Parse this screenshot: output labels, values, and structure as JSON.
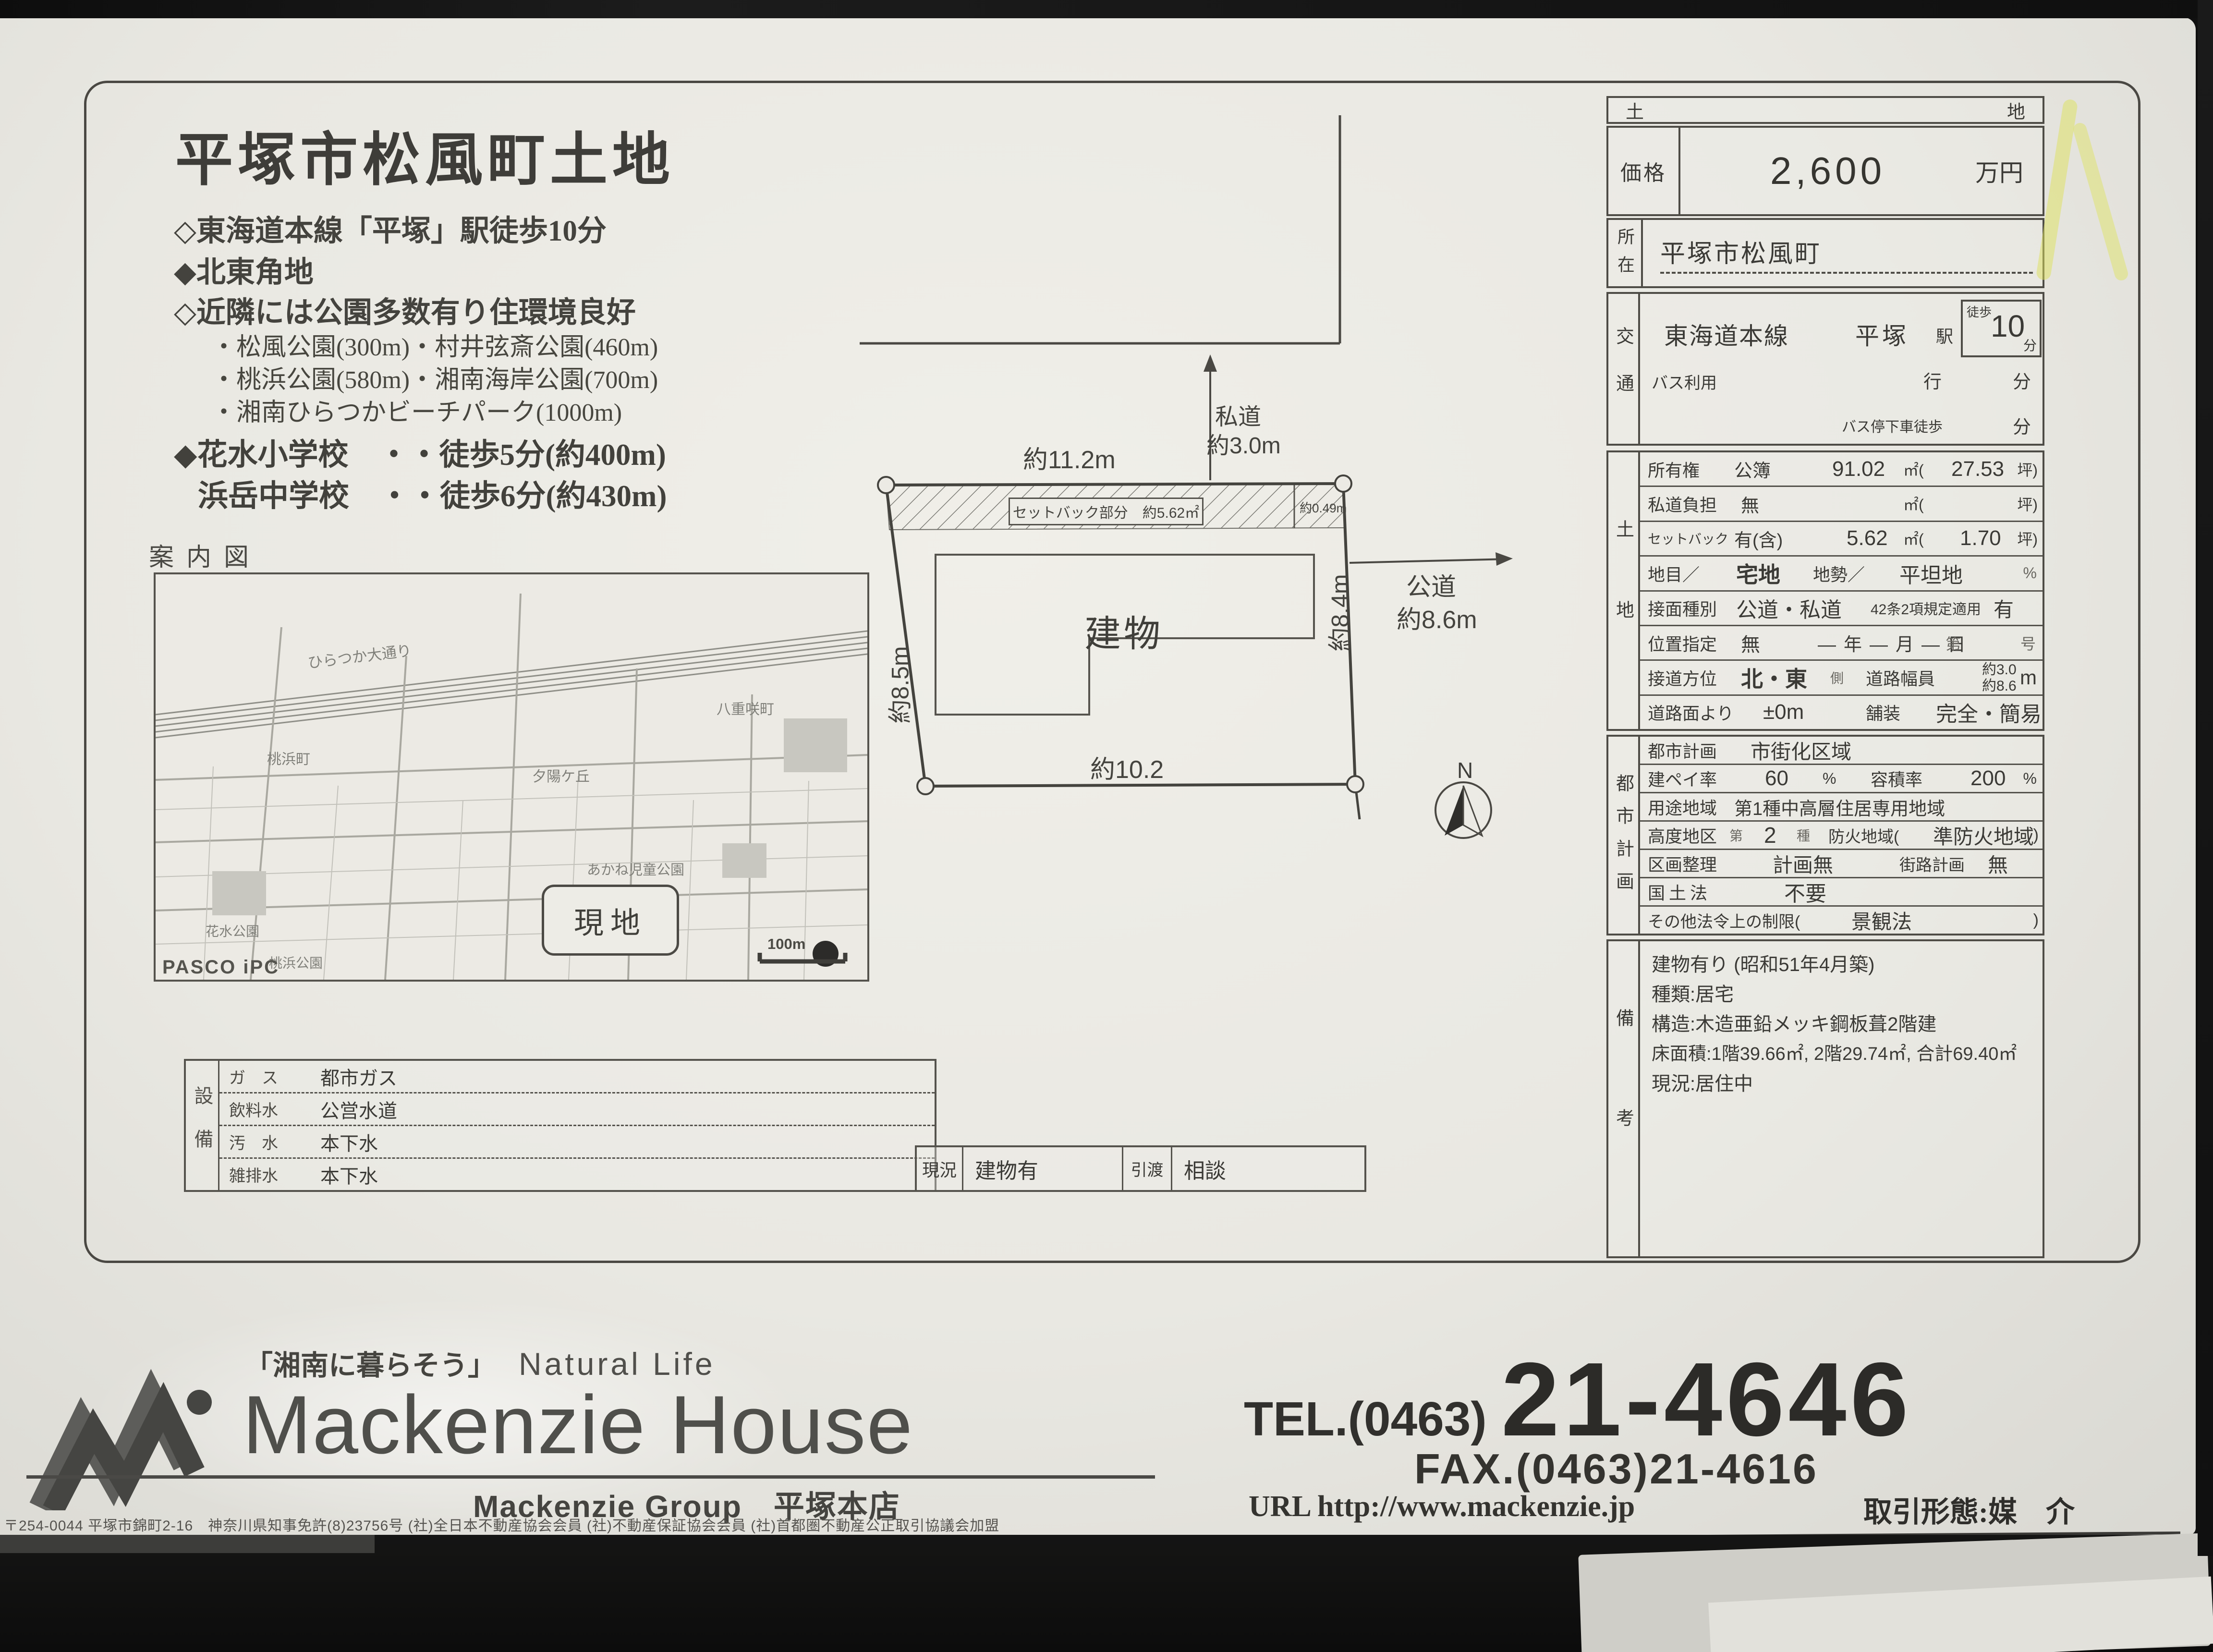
{
  "palette": {
    "background": "#141414",
    "paper": "#e9e8e2",
    "ink": "#3b3a36",
    "table_line": "#4e4c46",
    "map_ink": "#80807a",
    "highlighter": "#e0e45a"
  },
  "title_block": {
    "title": "平塚市松風町土地",
    "bullets": [
      "◇東海道本線「平塚」駅徒歩10分",
      "◆北東角地",
      "◇近隣には公園多数有り住環境良好"
    ],
    "parks": [
      "・松風公園(300m)・村井弦斎公園(460m)",
      "・桃浜公園(580m)・湘南海岸公園(700m)",
      "・湘南ひらつかビーチパーク(1000m)"
    ],
    "school_1": "◆花水小学校　・・徒歩5分(約400m)",
    "school_2": "浜岳中学校　・・徒歩6分(約430m)"
  },
  "guide_map": {
    "label": "案内図",
    "site_badge": "現地",
    "logo": "PASCO iPC",
    "scale": "100m",
    "streets": [
      "ひらつか大通り",
      "八重咲町",
      "夕陽ケ丘",
      "あかね児童公園",
      "桃浜町",
      "花水公園",
      "桃浜公園"
    ]
  },
  "site_plan": {
    "building_label": "建物",
    "top_width": "約11.2m",
    "bottom_width": "約10.2",
    "left_depth": "約8.5m",
    "right_depth": "約8.4m",
    "private_road_1": "私道",
    "private_road_2": "約3.0m",
    "public_road_1": "公道",
    "public_road_2": "約8.6m",
    "setback_box": "セットバック部分　約5.62㎡",
    "setback_depth": "約0.49m",
    "compass_n": "N"
  },
  "price_table": {
    "section_left": "土",
    "section_right": "地",
    "price_label": "価格",
    "price_value": "2,600",
    "price_unit": "万円",
    "location_label": "所在",
    "location_value": "平塚市松風町"
  },
  "access": {
    "label": "交通",
    "line": "東海道本線",
    "station": "平塚",
    "station_suffix": "駅",
    "walk_label": "徒歩",
    "walk_min": "10",
    "min_unit": "分",
    "bus_label": "バス利用",
    "bus_going": "行",
    "bus_min_unit": "分",
    "bus_stop_label": "バス停下車徒歩",
    "bus_stop_min_unit": "分"
  },
  "land": {
    "label": "土地",
    "r1": {
      "label": "所有権",
      "v1": "公簿",
      "v2": "91.02",
      "u2": "㎡(",
      "v3": "27.53",
      "u3": "坪)"
    },
    "r2": {
      "label": "私道負担",
      "v1": "無",
      "u2": "㎡(",
      "u3": "坪)"
    },
    "r3": {
      "label": "セットバック",
      "v1": "有(含)",
      "v2": "5.62",
      "u2": "㎡(",
      "v3": "1.70",
      "u3": "坪)"
    },
    "r4": {
      "label": "地目／",
      "v1": "宅地",
      "l2": "地勢／",
      "v2": "平坦地",
      "u3": "%"
    },
    "r5": {
      "label": "接面種別",
      "v1": "公道・私道",
      "l2": "42条2項規定適用",
      "v2": "有"
    },
    "r6": {
      "label": "位置指定",
      "v1": "無",
      "l2": "―年―月―日",
      "l3": "第",
      "u3": "号"
    },
    "r7": {
      "label": "接道方位",
      "v1": "北・東",
      "s1": "側",
      "l2": "道路幅員",
      "v2a": "約3.0",
      "v2b": "約8.6",
      "u3": "m"
    },
    "r8": {
      "label": "道路面より",
      "v1": "±0m",
      "l2": "舗装",
      "v2": "完全・簡易"
    }
  },
  "city_plan": {
    "label": "都市計画",
    "r1": {
      "label": "都市計画",
      "value": "市街化区域"
    },
    "r2": {
      "l1": "建ペイ率",
      "v1": "60",
      "u1": "%",
      "l2": "容積率",
      "v2": "200",
      "u2": "%"
    },
    "r3": {
      "label": "用途地域",
      "value": "第1種中高層住居専用地域"
    },
    "r4": {
      "l1": "高度地区",
      "p1": "第",
      "v1": "2",
      "p2": "種",
      "l2": "防火地域(",
      "v2": "準防火地域",
      "p3": ")"
    },
    "r5": {
      "l1": "区画整理",
      "v1": "計画無",
      "l2": "街路計画",
      "v2": "無"
    },
    "r6": {
      "label": "国土法",
      "value": "不要"
    },
    "r7": {
      "open": "その他法令上の制限(",
      "value": "景観法",
      "close": ")"
    }
  },
  "remarks": {
    "label": "備考",
    "lines": [
      "建物有り (昭和51年4月築)",
      "種類:居宅",
      "構造:木造亜鉛メッキ鋼板葺2階建",
      "床面積:1階39.66㎡, 2階29.74㎡, 合計69.40㎡",
      "現況:居住中"
    ]
  },
  "utilities": {
    "label": "設備",
    "rows": [
      {
        "k": "ガ　ス",
        "v": "都市ガス"
      },
      {
        "k": "飲料水",
        "v": "公営水道"
      },
      {
        "k": "汚　水",
        "v": "本下水"
      },
      {
        "k": "雑排水",
        "v": "本下水"
      }
    ]
  },
  "status_row": {
    "k1": "現況",
    "v1": "建物有",
    "k2": "引渡",
    "v2": "相談"
  },
  "footer": {
    "tagline_jp": "「湘南に暮らそう」",
    "tagline_en": "Natural Life",
    "company": "Mackenzie House",
    "group": "Mackenzie Group　平塚本店",
    "address_line": "〒254-0044 平塚市錦町2-16　神奈川県知事免許(8)23756号 (社)全日本不動産協会会員 (社)不動産保証協会会員 (社)首都圏不動産公正取引協議会加盟",
    "tel_prefix": "TEL.(0463)",
    "tel_number": "21-4646",
    "fax": "FAX.(0463)21-4616",
    "url": "URL http://www.mackenzie.jp",
    "deal_type": "取引形態:媒　介"
  }
}
